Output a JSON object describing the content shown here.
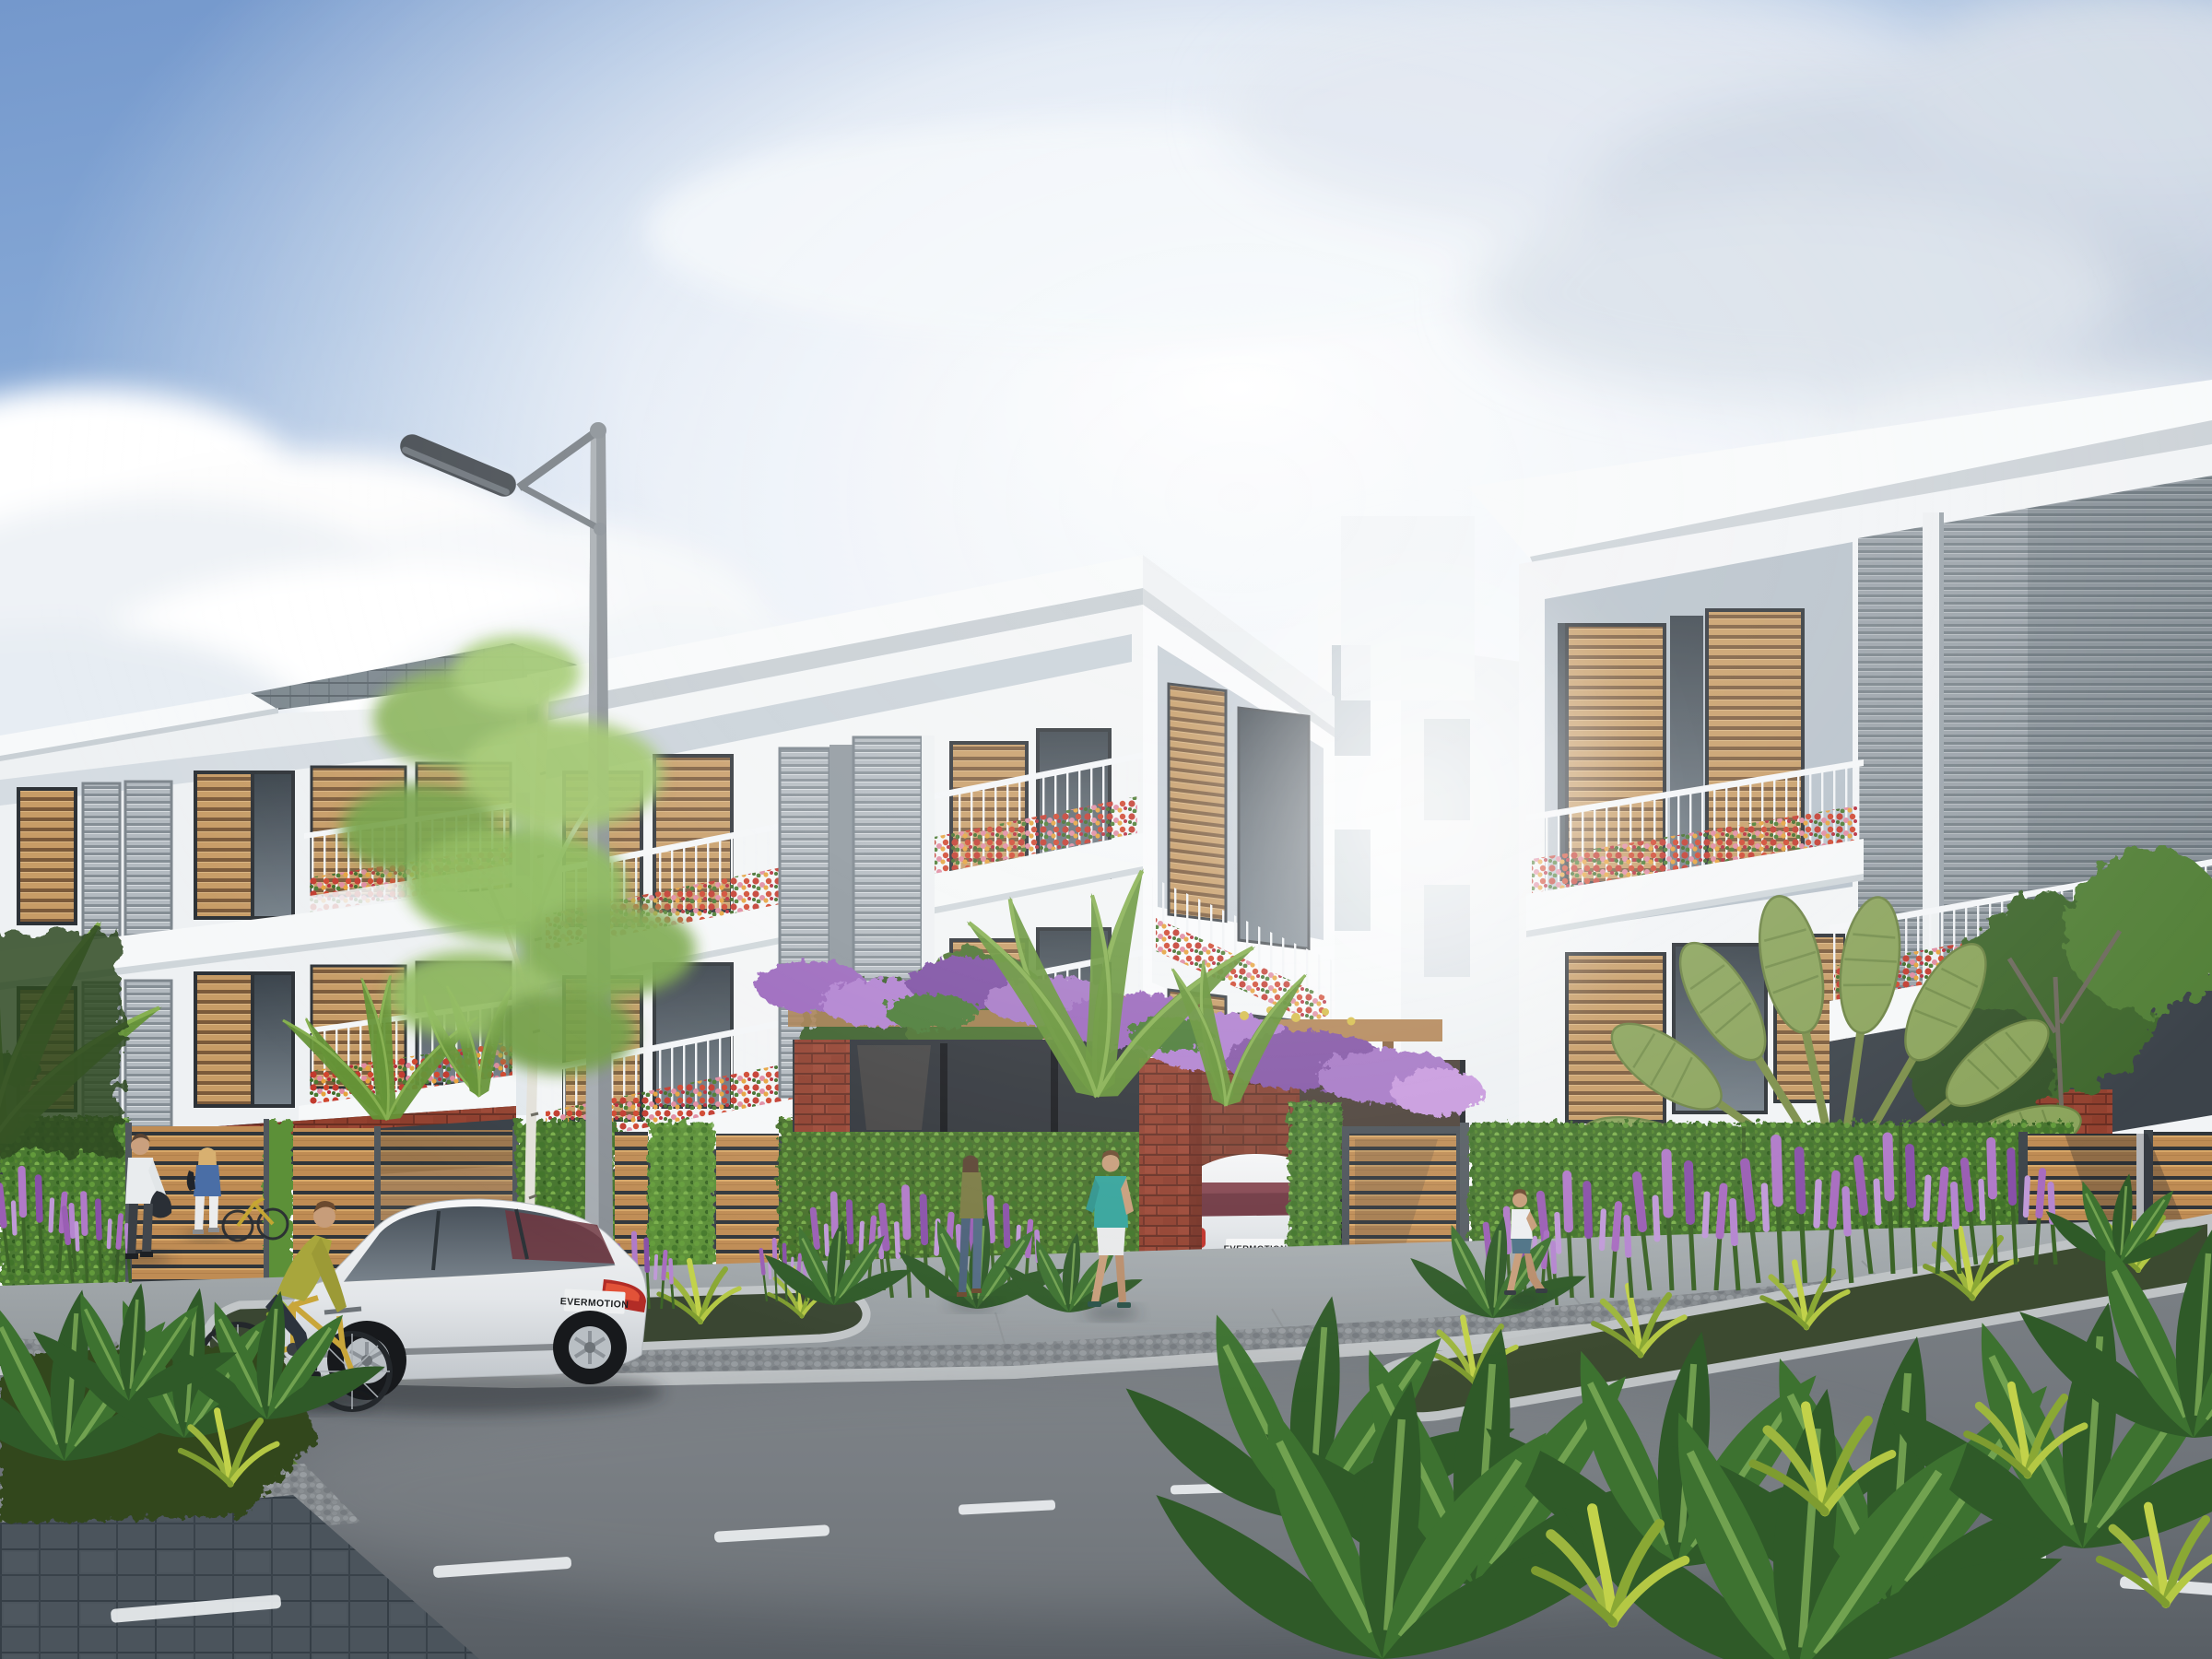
{
  "meta": {
    "kind": "architectural-exterior-rendering",
    "subject": "modern three-storey townhouse street view, daytime",
    "visible_text_note": "only text rendered in image is the EVERMOTION license plates"
  },
  "vehicles": {
    "street_car": {
      "type": "white coupe parked on street",
      "plate": "EVERMOTION"
    },
    "driveway_car": {
      "type": "white sedan at entrance driveway",
      "plate": "EVERMOTION"
    }
  },
  "buildings": {
    "left_villa": {
      "floors": 3,
      "facade": "white",
      "roof": "gray shingle + white fascia",
      "features": [
        "wood louver shutters",
        "gray metal louver screens",
        "balconies with red flower boxes",
        "brick ground floor"
      ]
    },
    "center_villa": {
      "floors": 3,
      "facade": "white",
      "roof": "white skillion overhang",
      "features": [
        "two tall gray louver panels",
        "wood louver windows",
        "wrap-around balconies with flowers",
        "brick and glass ground floor",
        "entrance pergola with purple vines"
      ]
    },
    "right_villa": {
      "floors": 3,
      "facade": "white",
      "roof": "white skillion overhang",
      "features": [
        "large gray louver wall with white fin",
        "wood louver sliding shutters",
        "two flower balconies"
      ]
    }
  },
  "people": [
    {
      "id": "man-white-shirt",
      "desc": "man in white shirt and dark trousers holding jacket, near left gate"
    },
    {
      "id": "woman-blue-top",
      "desc": "blonde woman in blue top and white trousers, facing gate"
    },
    {
      "id": "cyclist",
      "desc": "young man in olive sweater riding yellow bicycle"
    },
    {
      "id": "woman-olive",
      "desc": "woman in olive top and jeans walking near entrance"
    },
    {
      "id": "man-teal",
      "desc": "man in teal t-shirt and white shorts walking at driveway"
    },
    {
      "id": "jogger",
      "desc": "jogger in white top and blue shorts along right hedge"
    }
  ],
  "landscape": {
    "fence": "green hedge wall with horizontal wood-slat panels and gray posts",
    "flowers": [
      "purple salvia spikes",
      "red geranium balcony boxes",
      "purple wisteria on pergola"
    ],
    "trees": [
      "birch by street lamp",
      "palm fronds at entrance",
      "travelers palm at right",
      "tropical foreground leaves"
    ]
  },
  "street": {
    "elements": [
      "asphalt road with white dashed lane line",
      "granite curbs",
      "paved sidewalk with cobble strip",
      "dark tile plaza corner",
      "curved planting beds",
      "street lamp"
    ]
  },
  "palette": {
    "sky_blue": "#7a9ecf",
    "cloud_white": "#ffffff",
    "building_white": "#f3f5f6",
    "panel_gray": "#b7c1ca",
    "wood_tan": "#c79c66",
    "metal_louver": "#9aa3aa",
    "brick_red": "#93412f",
    "hedge_green": "#4c7a30",
    "salvia_purple": "#a06cc0",
    "flower_red": "#c23a2e",
    "asphalt_gray": "#71767b",
    "plaza_tile": "#4b545c"
  }
}
